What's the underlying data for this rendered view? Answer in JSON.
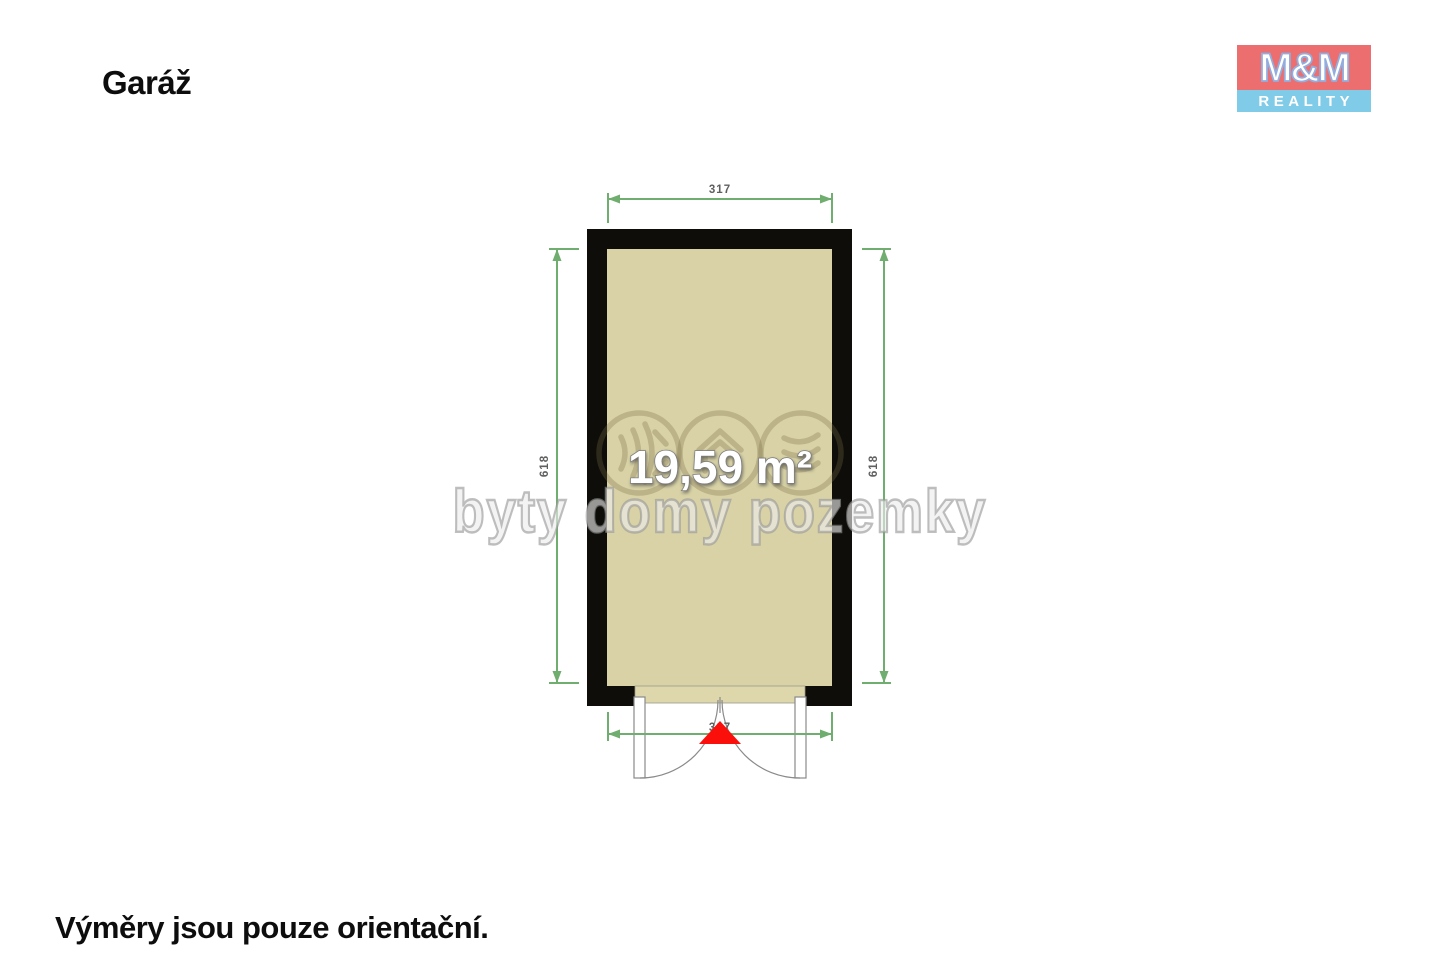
{
  "page": {
    "title": "Garáž",
    "footnote": "Výměry jsou pouze orientační.",
    "background": "#ffffff"
  },
  "logo": {
    "name": "M&M Reality",
    "line1": "M&M",
    "line2": "REALITY",
    "colors": {
      "red": "#ec6e6e",
      "blue": "#7fcbe8",
      "letter_outline": "#92aede"
    }
  },
  "plan": {
    "room": {
      "type": "garage",
      "area_label": "19,59 m²"
    },
    "dimensions": {
      "top": "317",
      "bottom": "317",
      "left": "618",
      "right": "618"
    },
    "colors": {
      "wall": "#0e0d09",
      "floor": "#d8d2a6",
      "threshold": "#ddd7ab",
      "dimension_line": "#6fae6f",
      "dimension_text": "#5f5f5f",
      "entrance_marker": "#fb0f0b"
    }
  },
  "watermark": {
    "text": "byty domy pozemky",
    "icons": [
      "waves-icon",
      "house-icon",
      "layers-icon"
    ]
  }
}
